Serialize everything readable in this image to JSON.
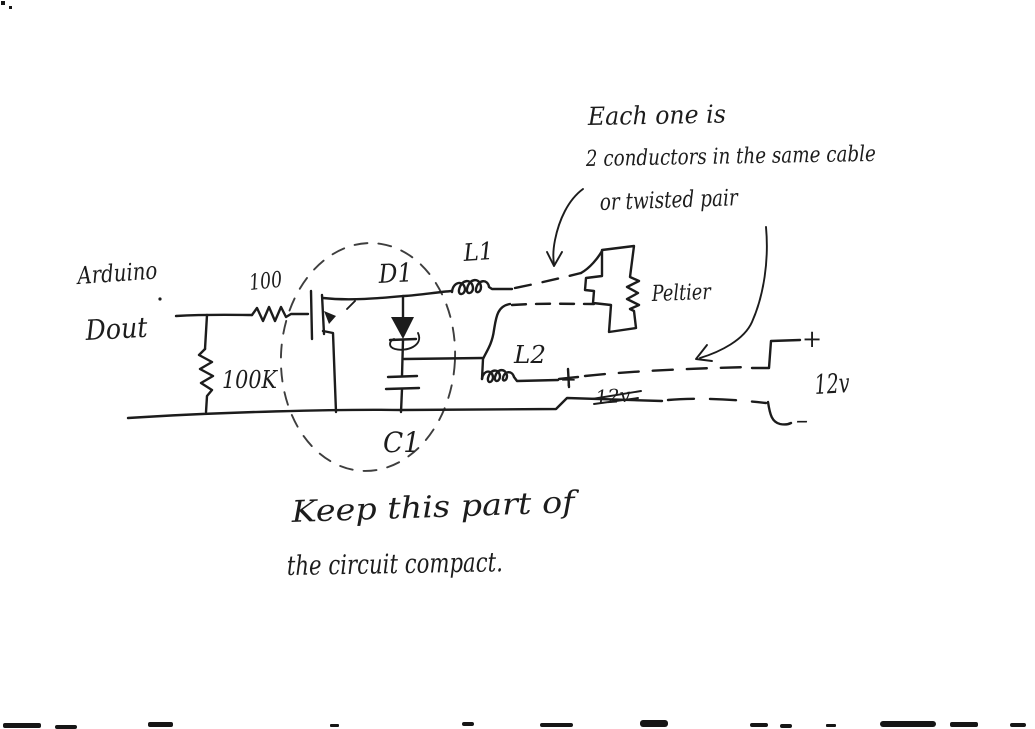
{
  "sketch": {
    "labels": {
      "source_line1": "Arduino",
      "source_line2": "Dout",
      "resistor_gate": "100",
      "resistor_pulldown": "100K",
      "diode": "D1",
      "capacitor": "C1",
      "inductor1": "L1",
      "inductor2": "L2",
      "load": "Peltier",
      "supply_voltage": "12v",
      "supply_plus": "+",
      "supply_minus": "–",
      "cable_plus": "+",
      "crossed_out_label": "12v"
    },
    "notes": {
      "cable_note_line1": "Each one is",
      "cable_note_line2": "2 conductors in the same cable",
      "cable_note_line3": "or twisted pair",
      "compact_note_line1": "Keep this part of",
      "compact_note_line2": "the circuit compact."
    },
    "colors": {
      "ink": "#1c1c1c",
      "paper": "#ffffff"
    }
  }
}
